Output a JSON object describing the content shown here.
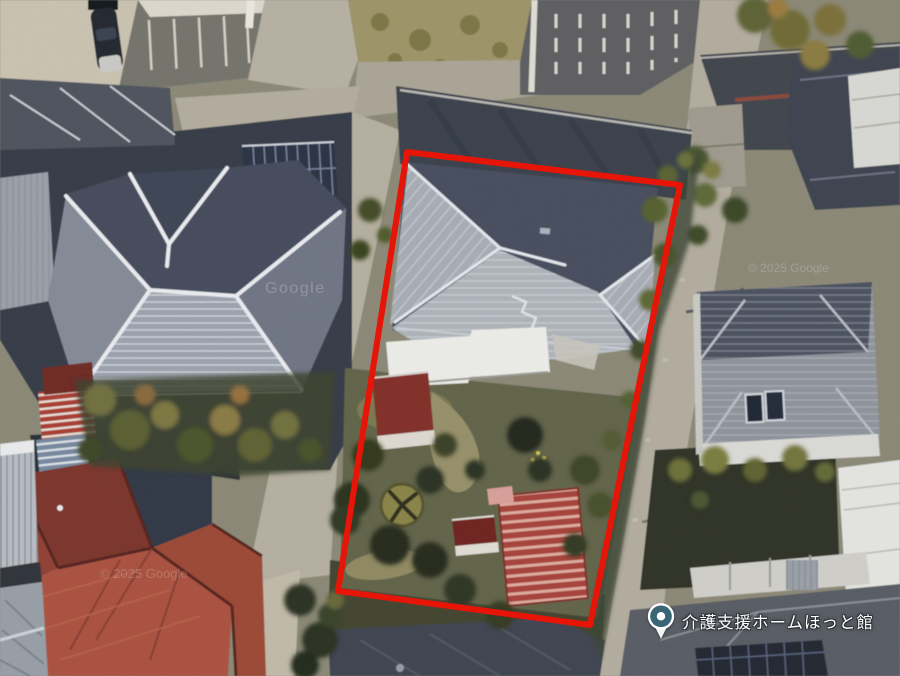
{
  "poi": {
    "name": "介護支援ホームほっと館"
  },
  "watermarks": {
    "google": "Google",
    "copyright": "© 2025 Google"
  },
  "overlay": {
    "boundary_color": "#e71408"
  },
  "pin": {
    "ring_color": "#3a6574"
  }
}
